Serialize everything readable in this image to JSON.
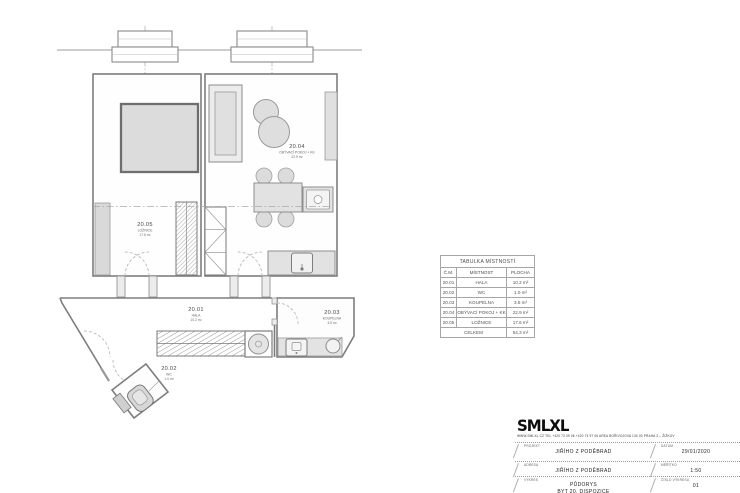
{
  "rooms": [
    {
      "id": "20.01",
      "name": "HALA",
      "area": "10.2 m²"
    },
    {
      "id": "20.02",
      "name": "WC",
      "area": "1.0 m²"
    },
    {
      "id": "20.03",
      "name": "KOUPELNA",
      "area": "3.5 m²"
    },
    {
      "id": "20.04",
      "name": "OBÝVACÍ POKOJ + KK",
      "area": "22.9 m²"
    },
    {
      "id": "20.05",
      "name": "LOŽNICE",
      "area": "17.6 m²"
    }
  ],
  "room_table": {
    "title": "TABULKA MÍSTNOSTÍ",
    "columns": [
      "Č.M.",
      "MÍSTNOST",
      "PLOCHA"
    ],
    "total_label": "CELKEM",
    "total_value": "54.3 m²"
  },
  "title_block": {
    "logo": "SMLXL",
    "contact": "WWW.SMLXL.CZ  TEL +420 73 09 06  +420 74 97 06  AREA BOŘIVOJOVA  130 00 PRAHA 3 – ŽIŽKOV",
    "project": {
      "label": "PROJEKT",
      "value": "JIŘÍHO Z PODĚBRAD"
    },
    "date": {
      "label": "DATUM",
      "value": "29/01/2020"
    },
    "address": {
      "label": "ADRESA",
      "value": "JIŘÍHO Z PODĚBRAD"
    },
    "scale": {
      "label": "MĚŘÍTKO",
      "value": "1:50"
    },
    "drawing": {
      "label": "VÝKRES",
      "value": "PŮDORYS",
      "value2": "BYT 20, DISPOZICE"
    },
    "number": {
      "label": "ČÍSLO VÝKRESU",
      "value": "01"
    }
  },
  "colors": {
    "plan_line": "#7d7d7d",
    "furniture_fill": "#e0e0e0",
    "text": "#555555",
    "logo": "#0d0d0d"
  }
}
